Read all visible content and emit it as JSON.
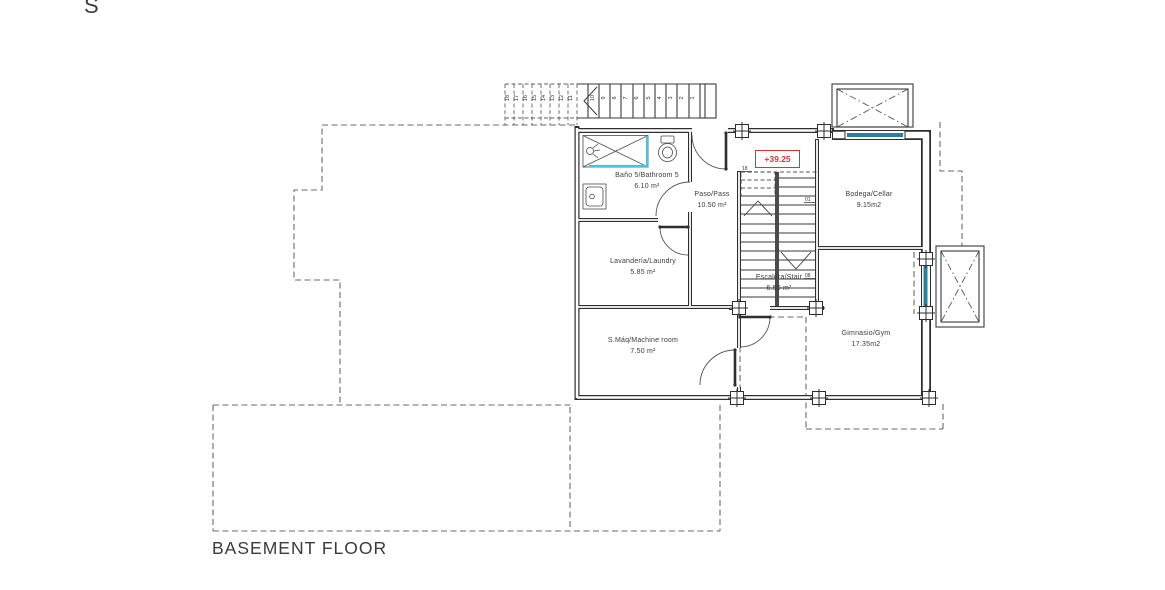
{
  "page": {
    "compass_letter": "S",
    "floor_title": "BASEMENT FLOOR",
    "level_marker": "+39.25"
  },
  "rooms": {
    "bathroom": {
      "name": "Baño 5/Bathroom 5",
      "area": "6.10 m²"
    },
    "pass": {
      "name": "Paso/Pass",
      "area": "10.50 m²"
    },
    "cellar": {
      "name": "Bodega/Cellar",
      "area": "9.15m2"
    },
    "laundry": {
      "name": "Lavandería/Laundry",
      "area": "5.85 m²"
    },
    "stair": {
      "name": "Escalera/Stair",
      "area": "6.50 m²"
    },
    "machine": {
      "name": "S.Máq/Machine room",
      "area": "7.50 m²"
    },
    "gym": {
      "name": "Gimnasio/Gym",
      "area": "17.35m2"
    }
  },
  "stair_step_labels": {
    "top": "18",
    "first": "01",
    "last": "08"
  },
  "exterior_stair_numbers": [
    "18",
    "17",
    "16",
    "15",
    "14",
    "13",
    "12",
    "11",
    "10",
    "9",
    "8",
    "7",
    "6",
    "5",
    "4",
    "3",
    "2",
    "1"
  ],
  "colors": {
    "line": "#2e2e2e",
    "dashed": "#6a6a6a",
    "window": "#2a7f9c",
    "shower": "#49c2de",
    "level_marker": "#d43535"
  }
}
